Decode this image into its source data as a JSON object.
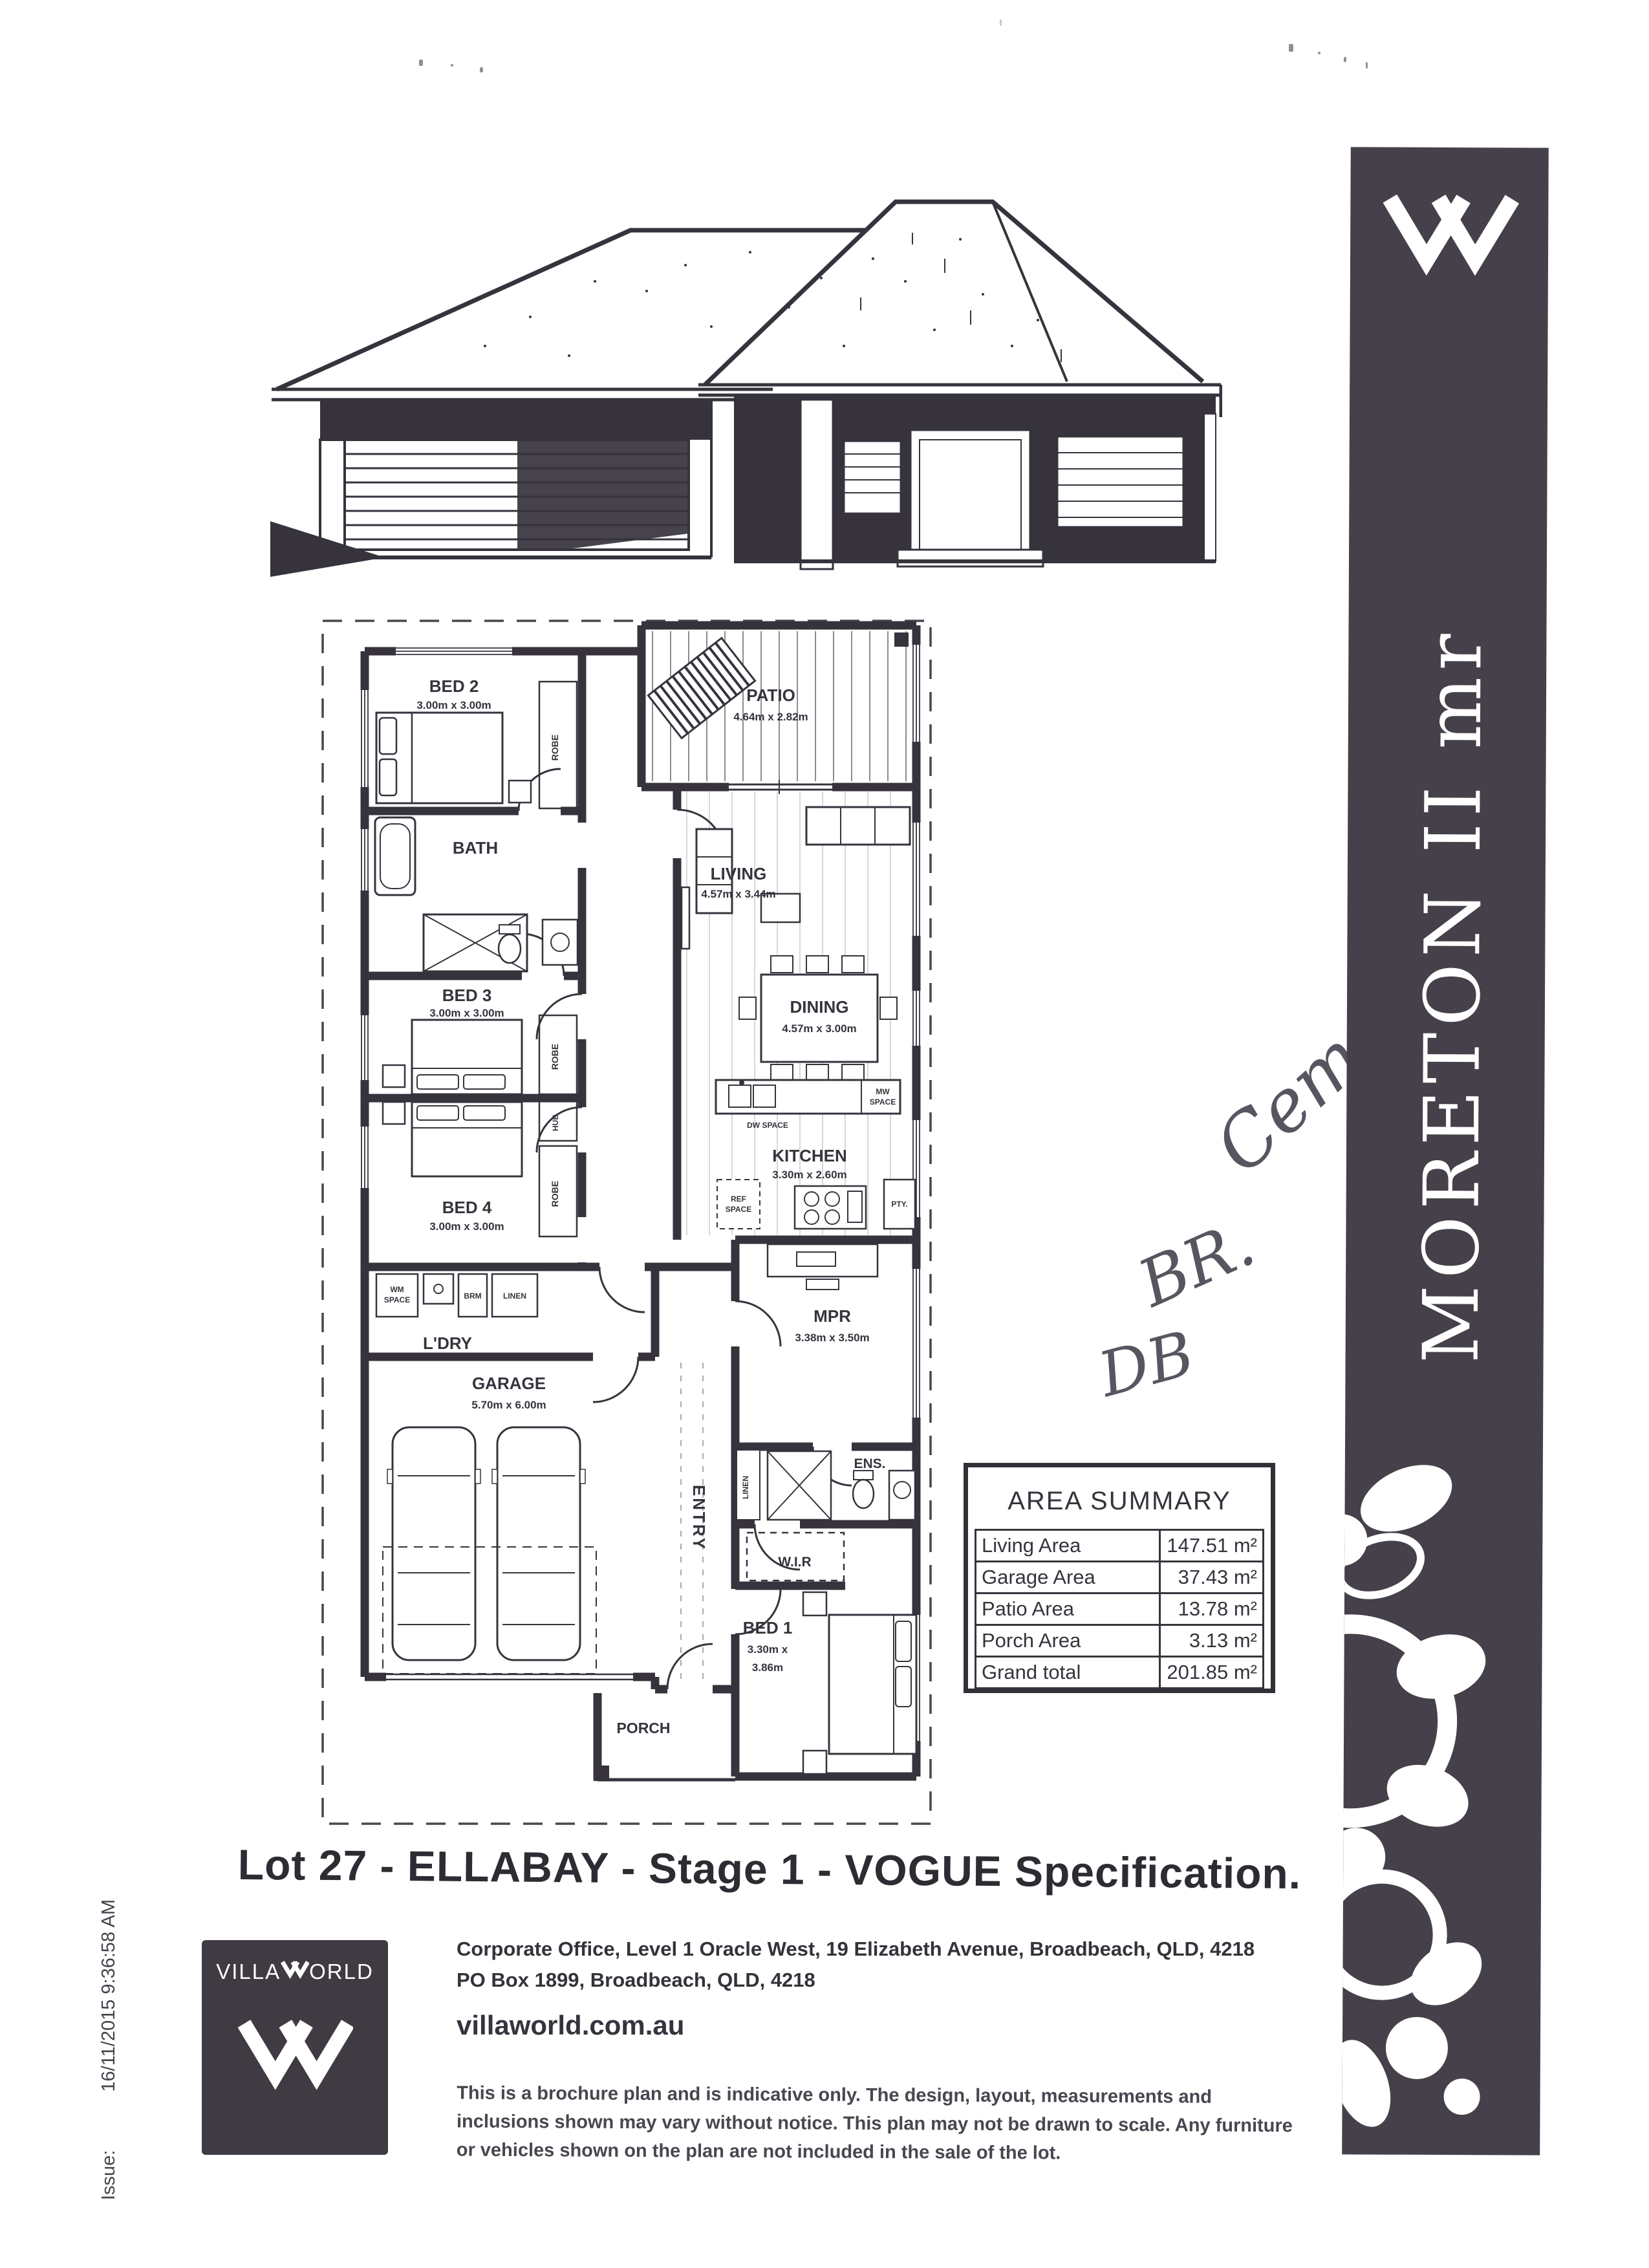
{
  "page": {
    "main_title": "Lot 27 - ELLABAY - Stage 1 - VOGUE Specification."
  },
  "issue": {
    "label": "Issue:",
    "timestamp": "16/11/2015 9:36:58 AM"
  },
  "sidebar": {
    "model_name": "MORETON II mr",
    "bg_color": "#454049",
    "logo_icon": "villaworld-double-v-icon"
  },
  "plan": {
    "labels": {
      "bed2_name": "BED 2",
      "bed2_dims": "3.00m x 3.00m",
      "patio_name": "PATIO",
      "patio_dims": "4.64m x 2.82m",
      "bath_name": "BATH",
      "living_name": "LIVING",
      "living_dims": "4.57m x 3.44m",
      "bed3_name": "BED 3",
      "bed3_dims": "3.00m x 3.00m",
      "dining_name": "DINING",
      "dining_dims": "4.57m x 3.00m",
      "kitchen_name": "KITCHEN",
      "kitchen_dims": "3.30m x 2.60m",
      "bed4_name": "BED 4",
      "bed4_dims": "3.00m x 3.00m",
      "ldry_name": "L'DRY",
      "garage_name": "GARAGE",
      "garage_dims": "5.70m x 6.00m",
      "mpr_name": "MPR",
      "mpr_dims": "3.38m x 3.50m",
      "entry_name": "ENTRY",
      "ens_name": "ENS.",
      "wir_name": "W.I.R",
      "bed1_name": "BED 1",
      "bed1_dims_l1": "3.30m x",
      "bed1_dims_l2": "3.86m",
      "porch_name": "PORCH",
      "robe": "ROBE",
      "hub": "HUB",
      "linen": "LINEN",
      "wm_l1": "WM",
      "wm_l2": "SPACE",
      "brm": "BRM",
      "ref_l1": "REF",
      "ref_l2": "SPACE",
      "pty": "PTY.",
      "mw_l1": "MW",
      "mw_l2": "SPACE",
      "dw": "DW SPACE"
    }
  },
  "area_summary": {
    "title": "AREA SUMMARY",
    "rows": [
      {
        "label": "Living Area",
        "value": "147.51 m²"
      },
      {
        "label": "Garage Area",
        "value": "37.43 m²"
      },
      {
        "label": "Patio Area",
        "value": "13.78 m²"
      },
      {
        "label": "Porch Area",
        "value": "3.13 m²"
      },
      {
        "label": "Grand total",
        "value": "201.85 m²"
      }
    ]
  },
  "annotations": {
    "a1": "Cem",
    "a2": "BR.",
    "a3": "DB"
  },
  "footer": {
    "brand": "VILLAWORLD",
    "brand_left": "VILLA",
    "brand_right": "ORLD",
    "address_line1": "Corporate Office, Level 1 Oracle West, 19 Elizabeth Avenue, Broadbeach,  QLD,  4218",
    "address_line2": "PO Box 1899, Broadbeach, QLD, 4218",
    "website": "villaworld.com.au",
    "disclaimer_line1": "This is a brochure plan and is indicative only. The design, layout, measurements and",
    "disclaimer_line2": "inclusions shown may vary without notice. This plan may not be drawn to scale. Any furniture",
    "disclaimer_line3": "or vehicles shown on the plan are not included in the sale of the lot."
  }
}
